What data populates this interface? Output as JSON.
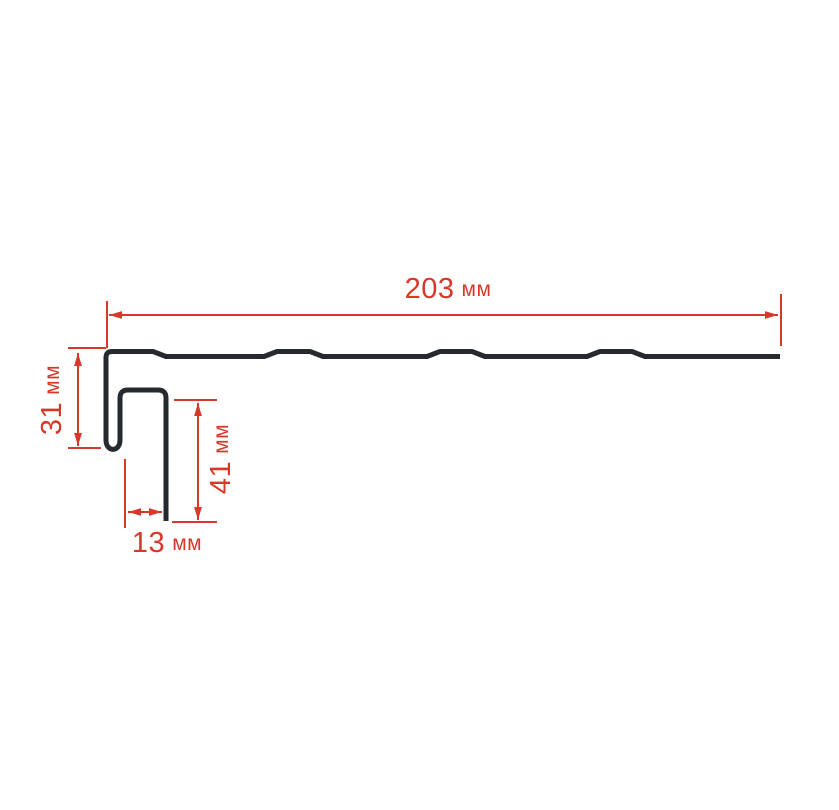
{
  "page": {
    "background": "#ffffff",
    "description_type": "profile-cross-section-dimension-drawing"
  },
  "colors": {
    "profile_line": "#26292e",
    "dimension_red": "#d6392a"
  },
  "diagram": {
    "dimensions": {
      "width_total": {
        "value": "203",
        "unit": "мм"
      },
      "height_left": {
        "value": "31",
        "unit": "мм"
      },
      "height_face": {
        "value": "41",
        "unit": "мм"
      },
      "width_channel": {
        "value": "13",
        "unit": "мм"
      }
    }
  }
}
